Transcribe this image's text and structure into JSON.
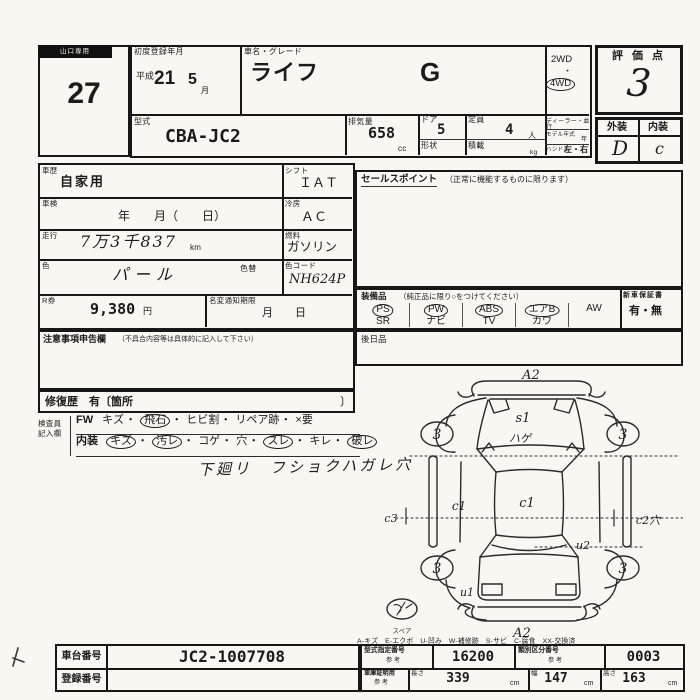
{
  "lot": {
    "region": "山口専用",
    "number": "27"
  },
  "registration": {
    "label": "初度登録年月",
    "era": "平成",
    "year": "21",
    "month": "5",
    "month_unit": "月"
  },
  "vehicle": {
    "name_label": "車名・グレード",
    "name": "ライフ",
    "grade": "G"
  },
  "drive": {
    "opt1": {
      "t": "2WD"
    },
    "dot": "・",
    "opt2": {
      "t": "4WD",
      "circled": true
    }
  },
  "model": {
    "label": "型式",
    "value": "CBA-JC2"
  },
  "displacement": {
    "label": "排気量",
    "value": "658",
    "unit": "cc"
  },
  "doors": {
    "label": "ドア",
    "value": "5"
  },
  "shape": {
    "label": "形状"
  },
  "capacity": {
    "label": "定員",
    "value": "4",
    "unit": "人"
  },
  "load": {
    "label": "積載",
    "unit": "kg"
  },
  "dealer": {
    "label": "ディーラー・並行"
  },
  "model_year": {
    "label": "モデル年式",
    "unit": "年"
  },
  "handle": {
    "label": "ハンドル",
    "value": "左・右"
  },
  "score": {
    "label": "評 価 点",
    "value": "3"
  },
  "finish": {
    "ext_label": "外装",
    "int_label": "内装",
    "ext": "D",
    "int": "c"
  },
  "details": {
    "history_label": "車歴",
    "history": "自家用",
    "shift_label": "シフト",
    "shift": "ＩＡＴ",
    "inspection_label": "車検",
    "inspection": "年　　月（　　日）",
    "cooling_label": "冷房",
    "cooling": "ＡＣ",
    "mileage_label": "走行",
    "mileage": "7万3千837",
    "mileage_unit": "km",
    "fuel_label": "燃料",
    "fuel": "ガソリン",
    "color_label": "色",
    "color": "パール",
    "color_change_label": "色替",
    "color_code_label": "色コード",
    "color_code": "NH624P",
    "ticket_label": "R券",
    "ticket": "9,380",
    "ticket_unit": "円",
    "rename_label": "名変通知期限",
    "rename_value": "月　　日"
  },
  "notes": {
    "title": "注意事項申告欄",
    "subtitle": "（不具合内容等は具体的に記入して下さい）"
  },
  "repair": {
    "text": "修復歴　有〔箇所",
    "close": "〕"
  },
  "inspector": {
    "label1": "検査員",
    "label2": "記入欄",
    "sep": "・",
    "fw_label": "FW",
    "fw_items": [
      {
        "t": "キズ"
      },
      {
        "t": "飛石",
        "circled": true
      },
      {
        "t": "ヒビ割"
      },
      {
        "t": "リペア跡"
      },
      {
        "t": "×要"
      }
    ],
    "interior_label": "内装",
    "interior_items": [
      {
        "t": "キズ",
        "circled": true
      },
      {
        "t": "汚レ",
        "circled": true
      },
      {
        "t": "コゲ"
      },
      {
        "t": "穴"
      },
      {
        "t": "スレ",
        "circled": true
      },
      {
        "t": "キレ"
      },
      {
        "t": "破レ",
        "circled": true
      }
    ],
    "note": "下廻リ　フショクハガレ穴"
  },
  "sales_point": {
    "title": "セールスポイント",
    "subtitle": "（正常に機能するものに限ります）"
  },
  "equipment": {
    "title": "装備品",
    "subtitle": "（純正品に限り○をつけてください）",
    "row1": [
      {
        "t": "PS",
        "circled": true
      },
      {
        "t": "PW",
        "circled": true
      },
      {
        "t": "ABS",
        "circled": true
      },
      {
        "t": "エアB",
        "circled": true
      },
      {
        "t": "AW"
      }
    ],
    "row2": [
      {
        "t": "SR"
      },
      {
        "t": "ナビ"
      },
      {
        "t": "TV"
      },
      {
        "t": "カワ"
      }
    ],
    "warranty_label": "新車保証書",
    "warranty_value": "有・無",
    "later_label": "後日品"
  },
  "diagram": {
    "front_bumper": "A2",
    "rear_bumper": "A2",
    "hood_mark": "s1",
    "hood_note": "ハゲ",
    "wheel_fl": "3",
    "wheel_fr": "3",
    "wheel_rl": "3",
    "wheel_rr": "3",
    "left_outer": "c3",
    "left_panel": "c1",
    "roof": "c1",
    "right_panel": "c2穴",
    "rear_right": "u2",
    "rear_left": "u1",
    "spare_label": "スペア"
  },
  "legend": {
    "text": "A-キズ　E-エクボ　U-凹み　W-補修跡　S-サビ　C-腐食　XX-交換済"
  },
  "bottom": {
    "chassis_label": "車台番号",
    "chassis": "JC2-1007708",
    "reg_label": "登録番号",
    "type_label": "型式指定番号",
    "type_sub": "参 考",
    "type": "16200",
    "class_label": "類別区分番号",
    "class_sub": "参 考",
    "class": "0003",
    "garage_label": "車庫証明用",
    "garage_sub": "参 考",
    "len_label": "長さ",
    "len": "339",
    "len_unit": "cm",
    "wid_label": "幅",
    "wid": "147",
    "wid_unit": "cm",
    "hgt_label": "高さ",
    "hgt": "163",
    "hgt_unit": "cm"
  }
}
